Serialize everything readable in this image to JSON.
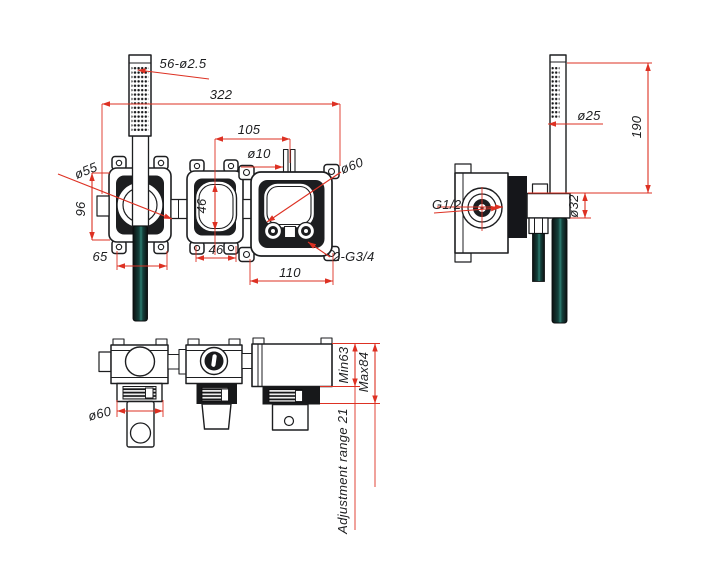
{
  "colors": {
    "line": "#1d1e20",
    "dimension": "#dd3123",
    "background": "#ffffff"
  },
  "front_view": {
    "spray_nozzles": "56-ø2.5",
    "overall_width": "322",
    "valve_center_spacing": "105",
    "inlet_pipe_dia": "ø10",
    "handle_escutcheon_dia": "ø55",
    "escutcheon_height": "96",
    "cartridge_opening_height": "46",
    "cartridge_opening_width": "46",
    "handle_offset": "65",
    "outlet_port_spacing": "110",
    "outlet_thread": "2-G3/4",
    "valve_opening_dia": "ø60"
  },
  "side_view": {
    "handset_dia": "ø25",
    "handset_length": "190",
    "inlet_thread": "G1/2",
    "bracket_outlet_dia": "ø32"
  },
  "bottom_view": {
    "spout_width_dia": "ø60",
    "min_depth": "Min63",
    "max_depth": "Max84",
    "adjustment_range": "Adjustment range 21"
  }
}
